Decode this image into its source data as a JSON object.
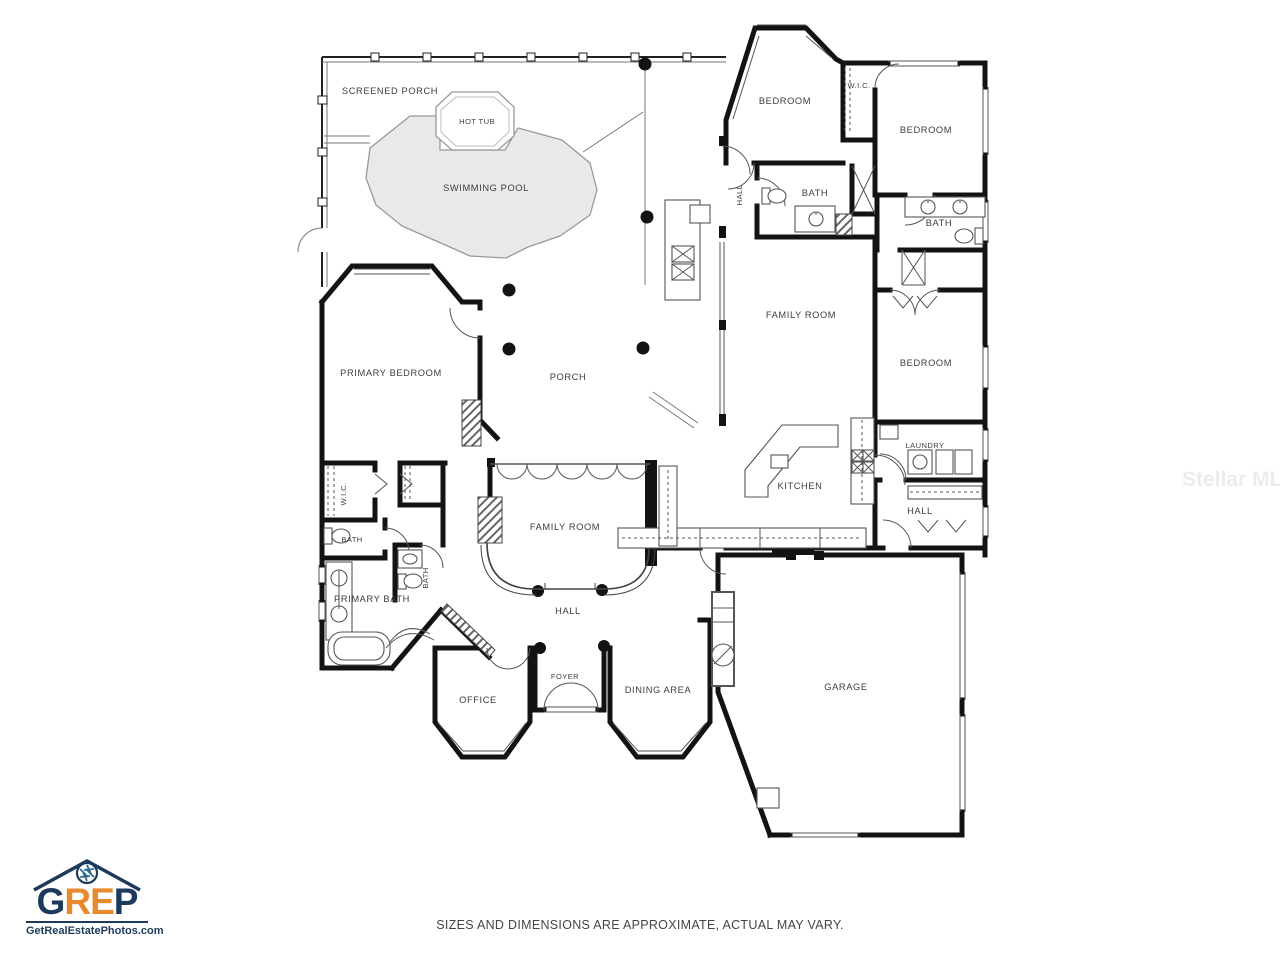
{
  "branding": {
    "logo_letters": [
      "G",
      "R",
      "E",
      "P"
    ],
    "logo_colors": {
      "navy": "#1d3a5c",
      "orange": "#e78a2e"
    },
    "website": "GetRealEstatePhotos.com",
    "logo_icon": "camera-aperture-over-house-roof"
  },
  "watermark": "Stellar MLS",
  "disclaimer": "SIZES AND DIMENSIONS ARE APPROXIMATE, ACTUAL MAY VARY.",
  "floor_plan": {
    "colors": {
      "wall": "#131313",
      "pool_fill": "#e9e9e9",
      "label": "#3d3d3d"
    },
    "rooms": [
      {
        "id": "screened-porch",
        "label": "SCREENED PORCH"
      },
      {
        "id": "hot-tub",
        "label": "HOT TUB"
      },
      {
        "id": "swimming-pool",
        "label": "SWIMMING POOL"
      },
      {
        "id": "bedroom-top",
        "label": "BEDROOM"
      },
      {
        "id": "wic-top",
        "label": "W.I.C."
      },
      {
        "id": "bedroom-top-right",
        "label": "BEDROOM"
      },
      {
        "id": "hall-top",
        "label": "HALL"
      },
      {
        "id": "bath-top",
        "label": "BATH"
      },
      {
        "id": "bath-right",
        "label": "BATH"
      },
      {
        "id": "family-room-right",
        "label": "FAMILY ROOM"
      },
      {
        "id": "bedroom-right",
        "label": "BEDROOM"
      },
      {
        "id": "primary-bedroom",
        "label": "PRIMARY BEDROOM"
      },
      {
        "id": "porch",
        "label": "PORCH"
      },
      {
        "id": "kitchen",
        "label": "KITCHEN"
      },
      {
        "id": "laundry",
        "label": "LAUNDRY"
      },
      {
        "id": "hall-right",
        "label": "HALL"
      },
      {
        "id": "family-room-center",
        "label": "FAMILY ROOM"
      },
      {
        "id": "wic-left",
        "label": "W.I.C."
      },
      {
        "id": "bath-left",
        "label": "BATH"
      },
      {
        "id": "bath-center",
        "label": "BATH"
      },
      {
        "id": "primary-bath",
        "label": "PRIMARY BATH"
      },
      {
        "id": "hall-bottom",
        "label": "HALL"
      },
      {
        "id": "office",
        "label": "OFFICE"
      },
      {
        "id": "foyer",
        "label": "FOYER"
      },
      {
        "id": "dining-area",
        "label": "DINING AREA"
      },
      {
        "id": "garage",
        "label": "GARAGE"
      }
    ]
  }
}
